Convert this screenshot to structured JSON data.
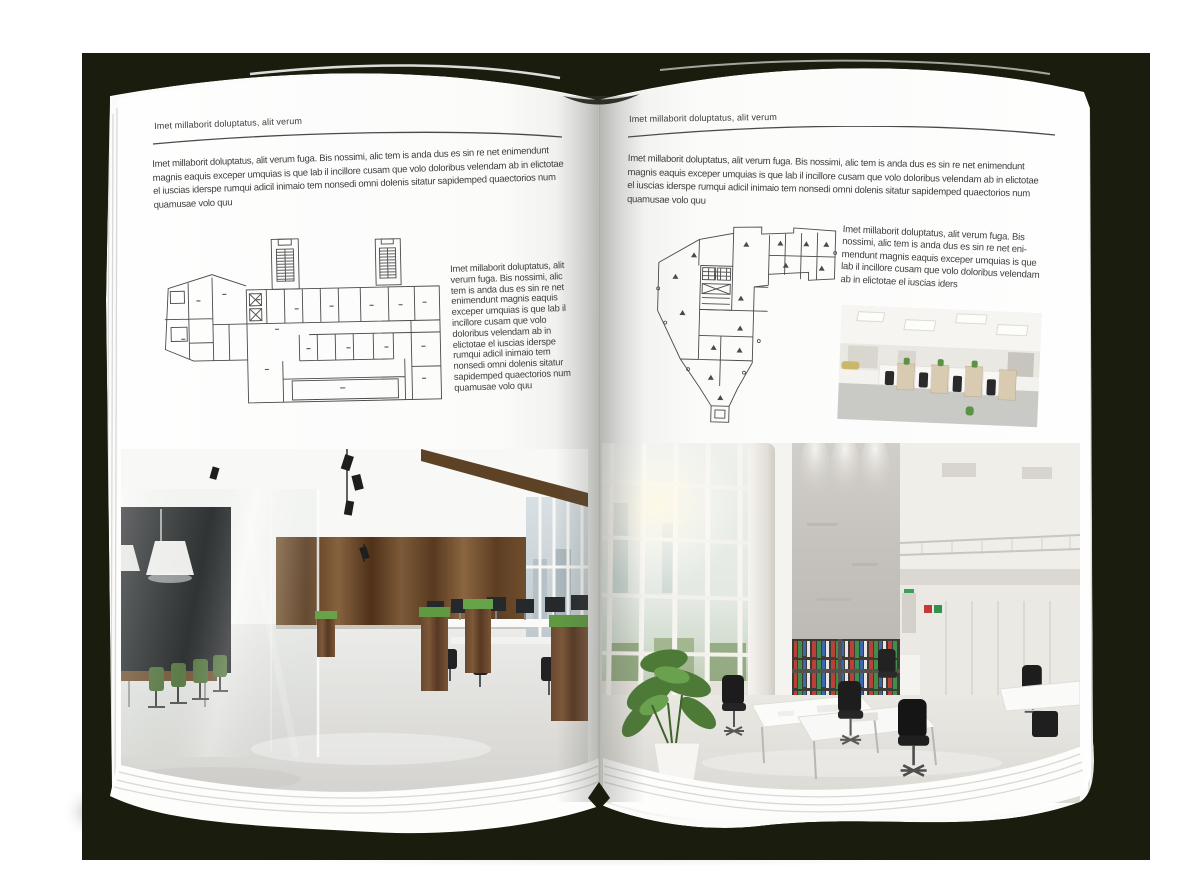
{
  "scene": {
    "mockup": "open-magazine-spread",
    "backdrop_color": "#1a1c0d",
    "page_color": "#ffffff",
    "text_color": "#3e3e3e"
  },
  "left_page": {
    "header": "Imet millaborit doluptatus, alit verum",
    "intro": "Imet millaborit doluptatus, alit verum fuga. Bis nossimi, alic tem is anda dus es sin re net enimendunt magnis eaquis exceper umquias is que lab il incillore cusam que volo doloribus velendam ab in elictotae el iuscias iderspe rumqui adicil inimaio tem nonsedi omni dolenis sitatur sapidemped quaectorios num quamusae volo quu",
    "side_text": "Imet millaborit doluptatus, alit verum fuga. Bis nossimi, alic tem is anda dus es sin re net enimendunt magnis eaquis exceper umquias is que lab il incillore cusam que volo doloribus velendam ab in elictotae el iuscias iderspe rumqui adicil inimaio tem nonsedi omni dolenis sitatur sapidemped quaectorios num quamusae volo quu",
    "figures": {
      "floor_plan": "architectural-floor-plan-wide-building",
      "photo": "office-interior-wood-paneling-glass-meeting-room"
    }
  },
  "right_page": {
    "header": "Imet millaborit doluptatus, alit verum",
    "intro": "Imet millaborit doluptatus, alit verum fuga. Bis nossimi, alic tem is anda dus es sin re net enimendunt magnis eaquis exceper umquias is que lab il incillore cusam que volo doloribus velendam ab in elictotae el iuscias iderspe rumqui adicil inimaio tem nonsedi omni dolenis sitatur sapidemped quaectorios num quamusae volo quu",
    "side_text": "Imet millaborit doluptatus, alit verum fuga. Bis nossimi, alic tem is anda dus es sin re net eni-mendunt magnis eaquis exceper umquias is que lab il incillore cusam que volo doloribus velendam ab in elictotae el iuscias iders",
    "figures": {
      "floor_plan": "architectural-floor-plan-irregular-tower",
      "photo_small": "open-plan-office-white-workstations",
      "photo_large": "double-height-office-atrium"
    }
  }
}
